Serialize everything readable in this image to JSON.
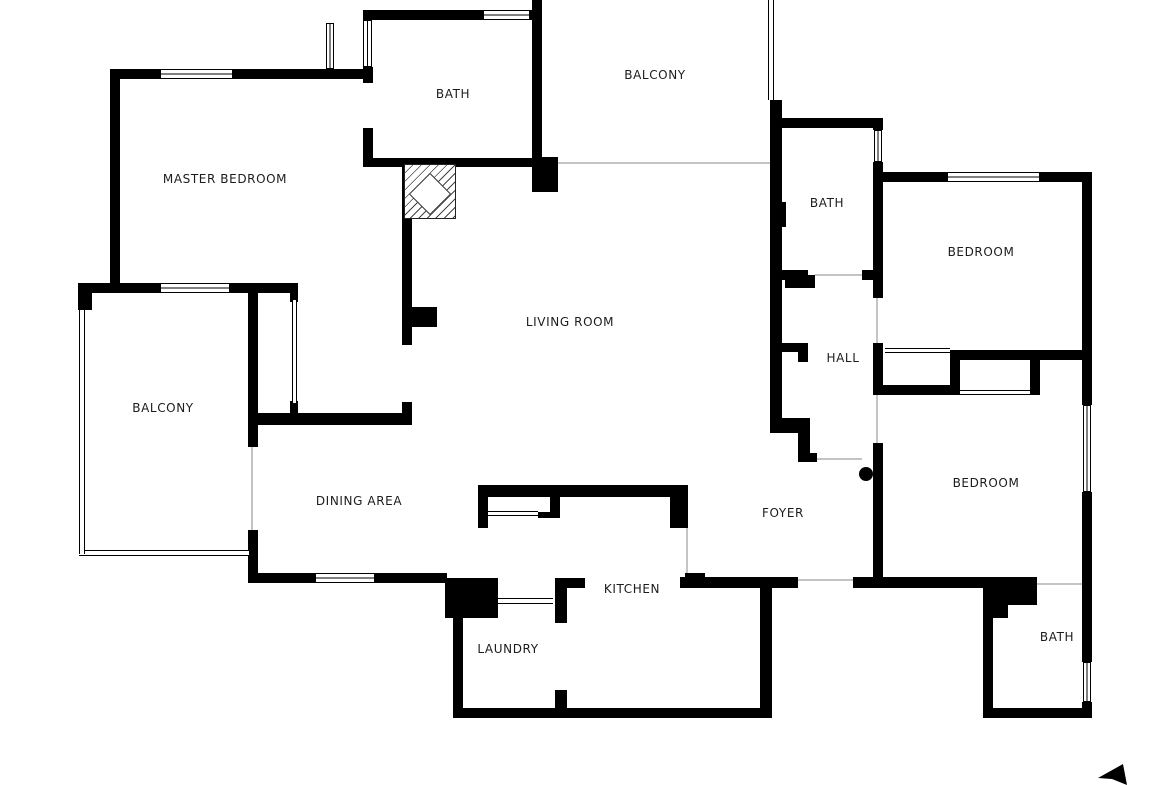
{
  "plan_title": "Apartment floor plan",
  "canvas": {
    "width": 1170,
    "height": 785,
    "background": "#ffffff"
  },
  "colors": {
    "wall": "#000000",
    "label": "#1c1c1c",
    "opening_line": "#c4c4c4",
    "window_frame": "#000000"
  },
  "rooms": [
    {
      "id": "master-bedroom",
      "label": "MASTER BEDROOM",
      "cx": 225,
      "cy": 179
    },
    {
      "id": "bath-master",
      "label": "BATH",
      "cx": 453,
      "cy": 94
    },
    {
      "id": "balcony-top",
      "label": "BALCONY",
      "cx": 655,
      "cy": 75
    },
    {
      "id": "bath-hall",
      "label": "BATH",
      "cx": 827,
      "cy": 203
    },
    {
      "id": "bedroom-1",
      "label": "BEDROOM",
      "cx": 981,
      "cy": 252
    },
    {
      "id": "living-room",
      "label": "LIVING ROOM",
      "cx": 570,
      "cy": 322
    },
    {
      "id": "hall",
      "label": "HALL",
      "cx": 843,
      "cy": 358
    },
    {
      "id": "balcony-left",
      "label": "BALCONY",
      "cx": 163,
      "cy": 408
    },
    {
      "id": "bedroom-2",
      "label": "BEDROOM",
      "cx": 986,
      "cy": 483
    },
    {
      "id": "dining-area",
      "label": "DINING AREA",
      "cx": 359,
      "cy": 501
    },
    {
      "id": "foyer",
      "label": "FOYER",
      "cx": 783,
      "cy": 513
    },
    {
      "id": "kitchen",
      "label": "KITCHEN",
      "cx": 632,
      "cy": 589
    },
    {
      "id": "laundry",
      "label": "LAUNDRY",
      "cx": 508,
      "cy": 649
    },
    {
      "id": "bath-2",
      "label": "BATH",
      "cx": 1057,
      "cy": 637
    }
  ],
  "geometry": {
    "walls": [
      [
        110,
        69,
        263,
        10
      ],
      [
        110,
        69,
        10,
        216
      ],
      [
        78,
        283,
        220,
        10
      ],
      [
        78,
        283,
        14,
        27
      ],
      [
        290,
        293,
        8,
        9
      ],
      [
        290,
        401,
        8,
        12
      ],
      [
        248,
        283,
        10,
        164
      ],
      [
        248,
        530,
        10,
        53
      ],
      [
        258,
        413,
        154,
        12
      ],
      [
        402,
        402,
        10,
        23
      ],
      [
        402,
        165,
        10,
        180
      ],
      [
        412,
        307,
        25,
        20
      ],
      [
        248,
        573,
        199,
        10
      ],
      [
        445,
        578,
        53,
        40
      ],
      [
        453,
        618,
        10,
        100
      ],
      [
        453,
        708,
        319,
        10
      ],
      [
        555,
        578,
        30,
        10
      ],
      [
        555,
        578,
        12,
        45
      ],
      [
        555,
        690,
        12,
        28
      ],
      [
        478,
        485,
        210,
        12
      ],
      [
        478,
        485,
        10,
        43
      ],
      [
        550,
        485,
        10,
        33
      ],
      [
        538,
        512,
        12,
        6
      ],
      [
        670,
        485,
        18,
        43
      ],
      [
        685,
        573,
        20,
        15
      ],
      [
        760,
        588,
        12,
        130
      ],
      [
        680,
        577,
        118,
        11
      ],
      [
        853,
        577,
        184,
        11
      ],
      [
        363,
        10,
        179,
        10
      ],
      [
        363,
        67,
        10,
        16
      ],
      [
        363,
        128,
        10,
        37
      ],
      [
        363,
        158,
        179,
        9
      ],
      [
        532,
        0,
        10,
        160
      ],
      [
        532,
        157,
        26,
        35
      ],
      [
        770,
        100,
        12,
        333
      ],
      [
        780,
        202,
        6,
        25
      ],
      [
        770,
        270,
        38,
        10
      ],
      [
        798,
        280,
        10,
        8
      ],
      [
        770,
        343,
        38,
        9
      ],
      [
        798,
        352,
        10,
        10
      ],
      [
        770,
        418,
        40,
        15
      ],
      [
        798,
        433,
        12,
        29
      ],
      [
        798,
        453,
        19,
        9
      ],
      [
        773,
        118,
        110,
        10
      ],
      [
        873,
        118,
        10,
        12
      ],
      [
        873,
        162,
        10,
        136
      ],
      [
        773,
        270,
        17,
        10
      ],
      [
        785,
        275,
        30,
        13
      ],
      [
        862,
        270,
        21,
        10
      ],
      [
        873,
        343,
        10,
        52
      ],
      [
        873,
        443,
        10,
        145
      ],
      [
        873,
        172,
        219,
        10
      ],
      [
        1082,
        172,
        10,
        233
      ],
      [
        1082,
        492,
        10,
        170
      ],
      [
        1082,
        702,
        10,
        16
      ],
      [
        950,
        350,
        142,
        10
      ],
      [
        950,
        360,
        10,
        33
      ],
      [
        873,
        385,
        87,
        10
      ],
      [
        1030,
        360,
        10,
        35
      ],
      [
        983,
        588,
        54,
        17
      ],
      [
        983,
        605,
        25,
        13
      ],
      [
        983,
        618,
        10,
        100
      ],
      [
        983,
        708,
        109,
        10
      ]
    ],
    "windows_h": [
      [
        160,
        69,
        73,
        10
      ],
      [
        483,
        10,
        47,
        10
      ],
      [
        947,
        172,
        93,
        10
      ],
      [
        160,
        283,
        70,
        10
      ],
      [
        315,
        573,
        60,
        10
      ]
    ],
    "windows_v": [
      [
        363,
        20,
        9,
        47
      ],
      [
        326,
        23,
        8,
        46
      ],
      [
        874,
        130,
        8,
        32
      ],
      [
        1083,
        405,
        8,
        87
      ],
      [
        1083,
        662,
        8,
        40
      ]
    ],
    "rails_h": [
      [
        79,
        550,
        170,
        6
      ],
      [
        885,
        348,
        65,
        5
      ],
      [
        960,
        390,
        70,
        5
      ],
      [
        488,
        511,
        50,
        5
      ],
      [
        498,
        598,
        55,
        6
      ]
    ],
    "rails_v": [
      [
        768,
        0,
        6,
        100
      ],
      [
        79,
        310,
        6,
        244
      ],
      [
        292,
        300,
        5,
        103
      ]
    ],
    "door_lines": [
      [
        558,
        162,
        212,
        2
      ],
      [
        251,
        447,
        2,
        83
      ],
      [
        815,
        274,
        47,
        2
      ],
      [
        876,
        298,
        2,
        45
      ],
      [
        876,
        395,
        2,
        48
      ],
      [
        817,
        458,
        45,
        2
      ],
      [
        798,
        579,
        55,
        2
      ],
      [
        1037,
        583,
        45,
        2
      ],
      [
        686,
        528,
        2,
        45
      ]
    ],
    "door_dot": [
      859,
      467,
      14,
      14
    ],
    "shower": [
      404,
      164,
      52,
      55
    ],
    "north_arrow": {
      "x": 1094,
      "y": 758,
      "w": 44,
      "h": 27,
      "points": "4,20 29,6 33,27 18,21"
    }
  }
}
